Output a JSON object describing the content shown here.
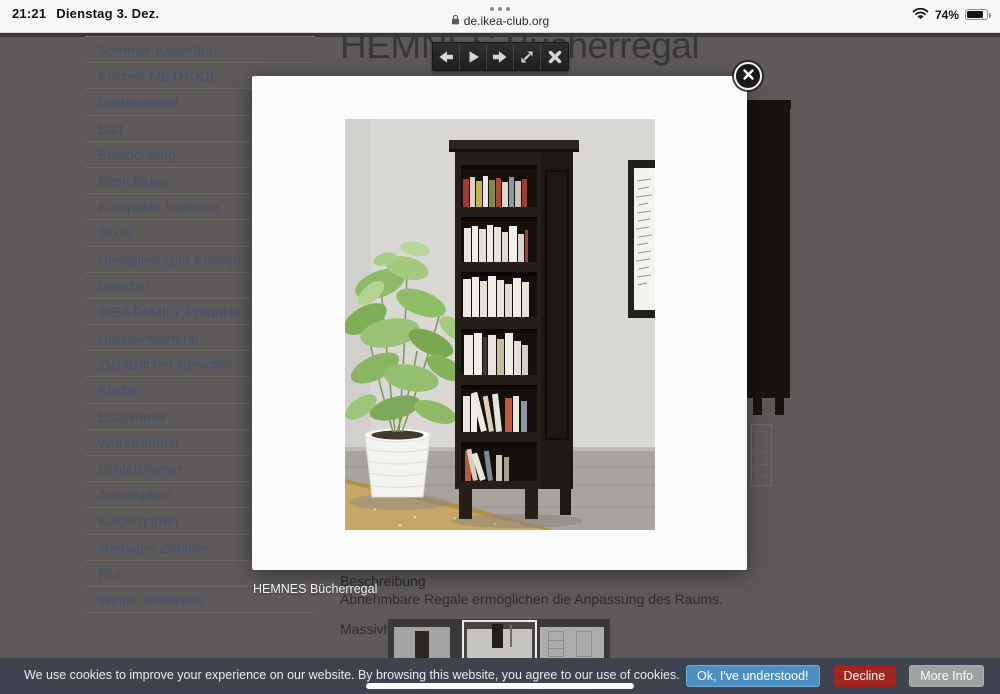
{
  "status_bar": {
    "time": "21:21",
    "date": "Dienstag 3. Dez.",
    "url": "de.ikea-club.org",
    "battery_percent": "74%"
  },
  "sidebar": {
    "items": [
      "Sommer-Kollektion",
      "Küchen METHODE",
      "Gartenmöbel",
      "Bad",
      "Beleuchtung",
      "Einrichtung",
      "Kompakte Speicher",
      "Textil-",
      "Utensilien zum Kochen",
      "Geschirr",
      "IKEA FAMILY Produkte",
      "Hauptwäscherei",
      "Zusätzlicher Speicher",
      "Küche",
      "Esszimmer",
      "Wohnzimmer",
      "Schlafzimmer",
      "Arbeitsplatz",
      "Kindergarten",
      "Teenager-Zimmer",
      "Flur",
      "Winter-Kollektion"
    ]
  },
  "page": {
    "title": "HEMNES Bücherregal",
    "description_heading": "Beschreibung",
    "description_text": "Abnehmbare Regale ermöglichen die Anpassung des Raums.",
    "material_label": "Massivholz"
  },
  "lightbox": {
    "caption": "HEMNES Bücherregal",
    "toolbar_icon_names": [
      "previous-arrow-icon",
      "play-icon",
      "next-arrow-icon",
      "expand-icon",
      "close-icon"
    ],
    "close_icon_name": "close-x-icon"
  },
  "cookie_banner": {
    "message": "We use cookies to improve your experience on our website. By browsing this website, you agree to our use of cookies.",
    "accept_label": "Ok, I've understood!",
    "decline_label": "Decline",
    "more_info_label": "More Info"
  },
  "colors": {
    "accept_blue": "#4d8fc4",
    "decline_red": "#a1241f",
    "more_info_gray": "#9aa3a1",
    "banner_bg": "#3d4450",
    "dimmed_page_bg": "#5e5a5a",
    "dimmed_link": "#46536d"
  }
}
